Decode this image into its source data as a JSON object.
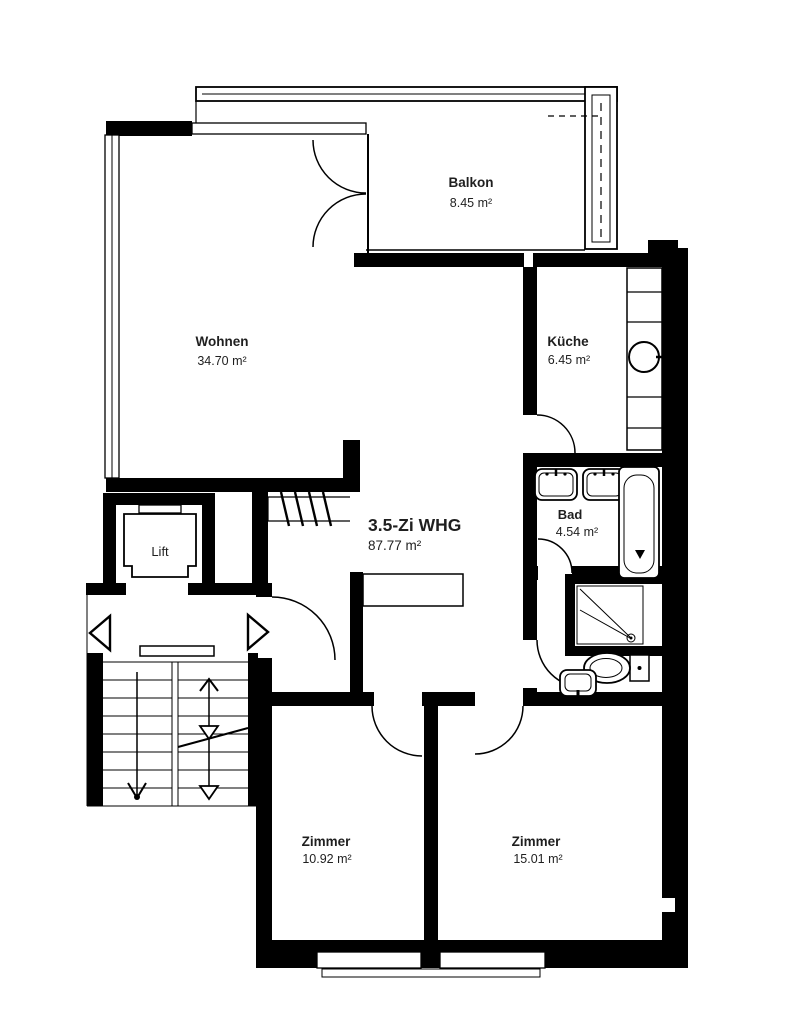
{
  "plan": {
    "apartment": {
      "title": "3.5-Zi WHG",
      "area": "87.77 m²"
    },
    "rooms": {
      "balkon": {
        "name": "Balkon",
        "area": "8.45 m²"
      },
      "wohnen": {
        "name": "Wohnen",
        "area": "34.70 m²"
      },
      "kueche": {
        "name": "Küche",
        "area": "6.45 m²"
      },
      "bad": {
        "name": "Bad",
        "area": "4.54 m²"
      },
      "zimmer_links": {
        "name": "Zimmer",
        "area": "10.92 m²"
      },
      "zimmer_rechts": {
        "name": "Zimmer",
        "area": "15.01 m²"
      },
      "lift": {
        "name": "Lift"
      }
    },
    "colors": {
      "walls": "#000000",
      "background": "#ffffff",
      "text": "#1f1f1f"
    }
  }
}
